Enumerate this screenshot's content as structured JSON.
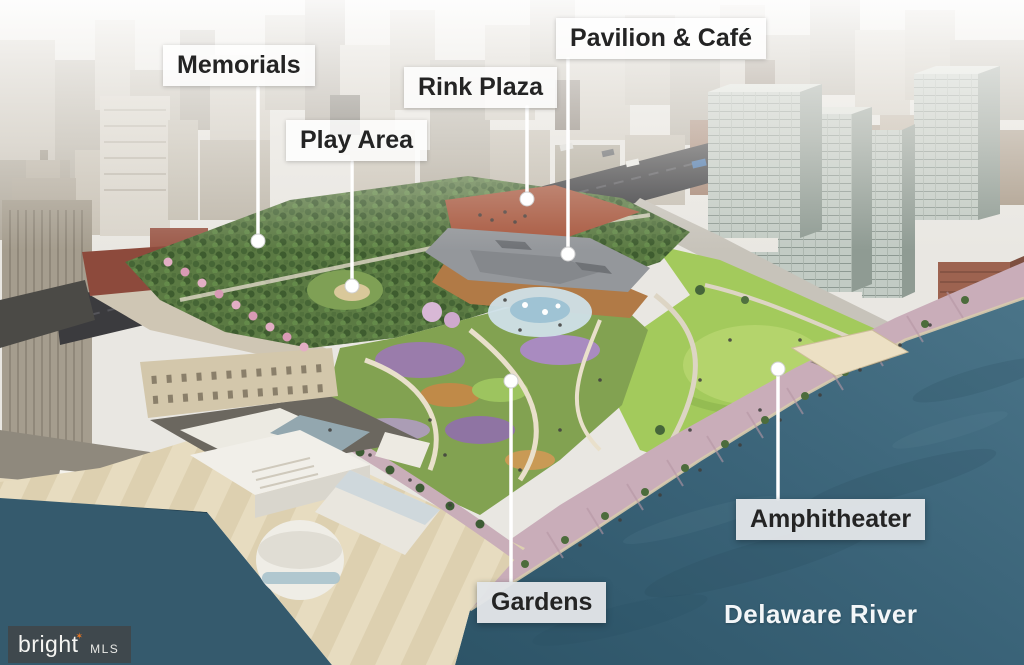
{
  "callouts": {
    "memorials": "Memorials",
    "play_area": "Play Area",
    "rink_plaza": "Rink Plaza",
    "pavilion_cafe": "Pavilion & Café",
    "gardens": "Gardens",
    "amphitheater": "Amphitheater"
  },
  "river": {
    "name": "Delaware River"
  },
  "watermark": {
    "brand": "bright",
    "star": "✶",
    "suffix": "MLS"
  },
  "colors": {
    "water": "#3a6378",
    "lawn": "#a3ca5c",
    "trees": "#51703c",
    "callout_bg": "#ffffff",
    "callout_text": "#242424",
    "leader_line": "#ffffff",
    "river_text": "#f3f6f8",
    "watermark_bg": "#424244",
    "watermark_accent": "#e87722",
    "promenade": "#c9adb9"
  }
}
